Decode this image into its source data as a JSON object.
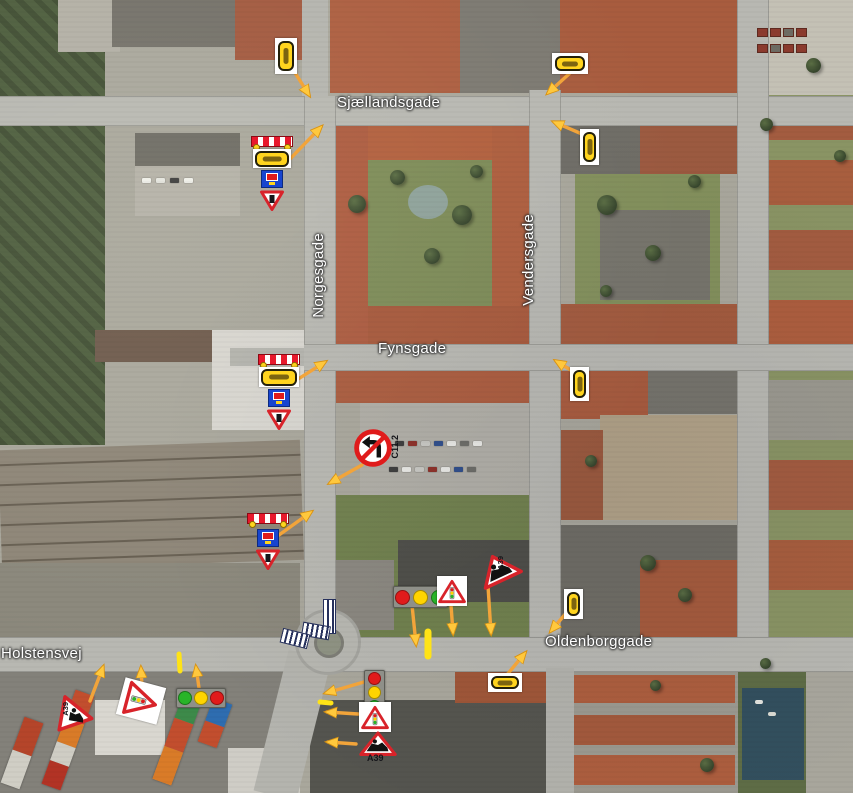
{
  "map_overlay": {
    "street_labels": {
      "sjaellandsgade": "Sjællandsgade",
      "norgesgade": "Norgesgade",
      "vendersgade": "Vendersgade",
      "fynsgade": "Fynsgade",
      "oldenborggade": "Oldenborggade",
      "holstensvej": "Holstensvej"
    },
    "sign_codes": {
      "no_left_turn": "C11.2",
      "roadworks": "A39"
    },
    "signs": [
      {
        "icon": "marker-plate-icon",
        "shape": "yellow rounded plate on white backing",
        "count": 6
      },
      {
        "icon": "barrier-board-icon",
        "shape": "red/white striped board with yellow lamps",
        "count": 3
      },
      {
        "icon": "detour-blue-sign-icon",
        "shape": "blue square board",
        "count": 3
      },
      {
        "icon": "give-way-triangle-icon",
        "shape": "inverted red/white triangle",
        "count": 3
      },
      {
        "icon": "traffic-light-icon",
        "shape": "grey housing with red/yellow/green bulbs",
        "count": 3
      },
      {
        "icon": "signal-ahead-triangle-icon",
        "code_hint": "A19",
        "count": 3
      },
      {
        "icon": "roadworks-triangle-icon",
        "code_hint": "A39",
        "count": 3
      },
      {
        "icon": "no-left-turn-icon",
        "code_hint": "C11.2",
        "count": 1
      },
      {
        "icon": "barrier-stripe",
        "shape": "blue/white hatched barrier line",
        "count": 3
      },
      {
        "icon": "direction-arrow",
        "shape": "orange arrow with yellow head",
        "count": 19
      }
    ],
    "colors": {
      "arrow": "#F2A43A",
      "arrow_head": "#FFC83D",
      "plate_yellow": "#FFD41E",
      "sign_red": "#D8232A",
      "light_red": "#E01B1B",
      "light_yellow": "#FFD400",
      "light_green": "#28B428",
      "detour_blue": "#1845CF",
      "label_white": "#FFFFFF"
    }
  }
}
